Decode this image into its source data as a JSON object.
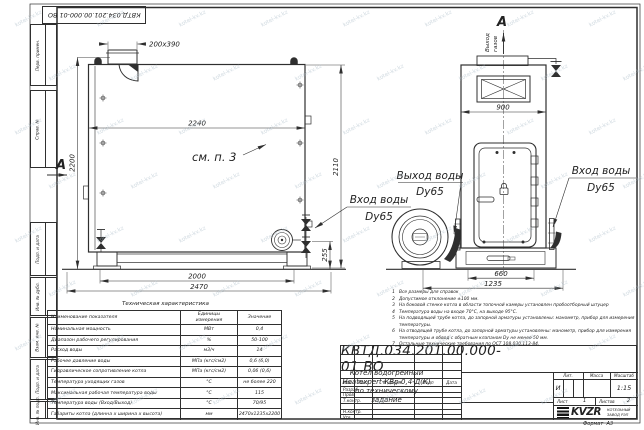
{
  "watermark": "kotel-kv.kz",
  "stamp": {
    "doc_number_rotated": "КВТД.034.201.00.000-01 ВО"
  },
  "margin_labels": [
    "Перв. примен.",
    "Справ. №",
    "Подп. и дата",
    "Инв. № дубл.",
    "Взам. инв. №",
    "Подп. и дата",
    "Инв. № подл."
  ],
  "front_view": {
    "section_mark": "А",
    "dim_stub": "200x390",
    "dim_width_top": "2240",
    "dim_height_left": "2200",
    "dim_height_right": "2110",
    "dim_flange_height": "255",
    "dim_legs": "2000",
    "dim_total_width": "2470",
    "see_note": "см. п. 3",
    "inlet_line1": "Вход воды",
    "inlet_line2": "Dy65"
  },
  "side_view": {
    "section_mark": "А",
    "gas_outlet_line1": "Выход",
    "gas_outlet_line2": "газов",
    "dim_width": "900",
    "dim_base": "660",
    "dim_total_depth": "1235",
    "outlet_line1": "Выход воды",
    "outlet_line2": "Dy65",
    "inlet_line1": "Вход воды",
    "inlet_line2": "Dy65"
  },
  "notes": [
    "Все размеры для справок",
    "Допустимое отклонение ±100 мм.",
    "На боковой стенке котла в области топочной камеры установлен пробоотборный штуцер",
    "Температура воды на входе 70°С, на выходе 95°С.",
    "На подводящей трубе котла, до запорной арматуры установлены: манометр, прибор для измерения температуры.",
    "На отводящей трубе котла, до запорной арматуры установлены: манометр, прибор для измерения температуры и обвод с обратным клапаном Dу не менее 50 мм.",
    "Остальные технические требования по ОСТ 108.030.113-84."
  ],
  "tech_table": {
    "title": "Техническая характеристика",
    "headers": [
      "Наименование показателя",
      "Единицы измерения",
      "Значение"
    ],
    "rows": [
      [
        "Номинальная мощность",
        "МВт",
        "0,4"
      ],
      [
        "Диапазон рабочего регулирования",
        "%",
        "50-100"
      ],
      [
        "Расход воды",
        "м3/ч",
        "14"
      ],
      [
        "Рабочее давление воды",
        "МПа (кгс/см2)",
        "0,6 (6,0)"
      ],
      [
        "Гидравлическое сопротивление котла",
        "МПа (кгс/см2)",
        "0,06 (0,6)"
      ],
      [
        "Температура уходящих газов",
        "°С",
        "не более 220"
      ],
      [
        "Максимальная рабочая температура воды",
        "°С",
        "115"
      ],
      [
        "Температура воды (Вход/Выход)",
        "°С",
        "70/95"
      ],
      [
        "Габариты котла (длинна х ширина х высота)",
        "мм",
        "2470х1235х2200"
      ]
    ]
  },
  "title_block": {
    "doc_number": "КВТД.034.201.00.000-01 ВО",
    "name_line1": "Котел водогрейный",
    "name_line2": "Heatexpert-КВр-0,4-Д(К)",
    "name_line3": "по техническому задание",
    "header_row": [
      "Изм",
      "Лист",
      "N докум.",
      "Подп",
      "Дата"
    ],
    "staff_rows": [
      "Разраб.",
      "Пров.",
      "Т.контр.",
      "",
      "Н.контр.",
      "Утв."
    ],
    "lit_label": "Лит.",
    "lit_value": "И",
    "mass_label": "Масса",
    "scale_label": "Масштаб",
    "scale_value": "1:15",
    "sheet_label": "Лист",
    "sheet_value": "1",
    "sheets_label": "Листов",
    "sheets_value": "2",
    "logo_text": "KVZR",
    "company_line1": "КОТЕЛЬНЫЙ",
    "company_line2": "ЗАВОД РЭП",
    "format_label": "Формат",
    "format_value": "А3"
  }
}
